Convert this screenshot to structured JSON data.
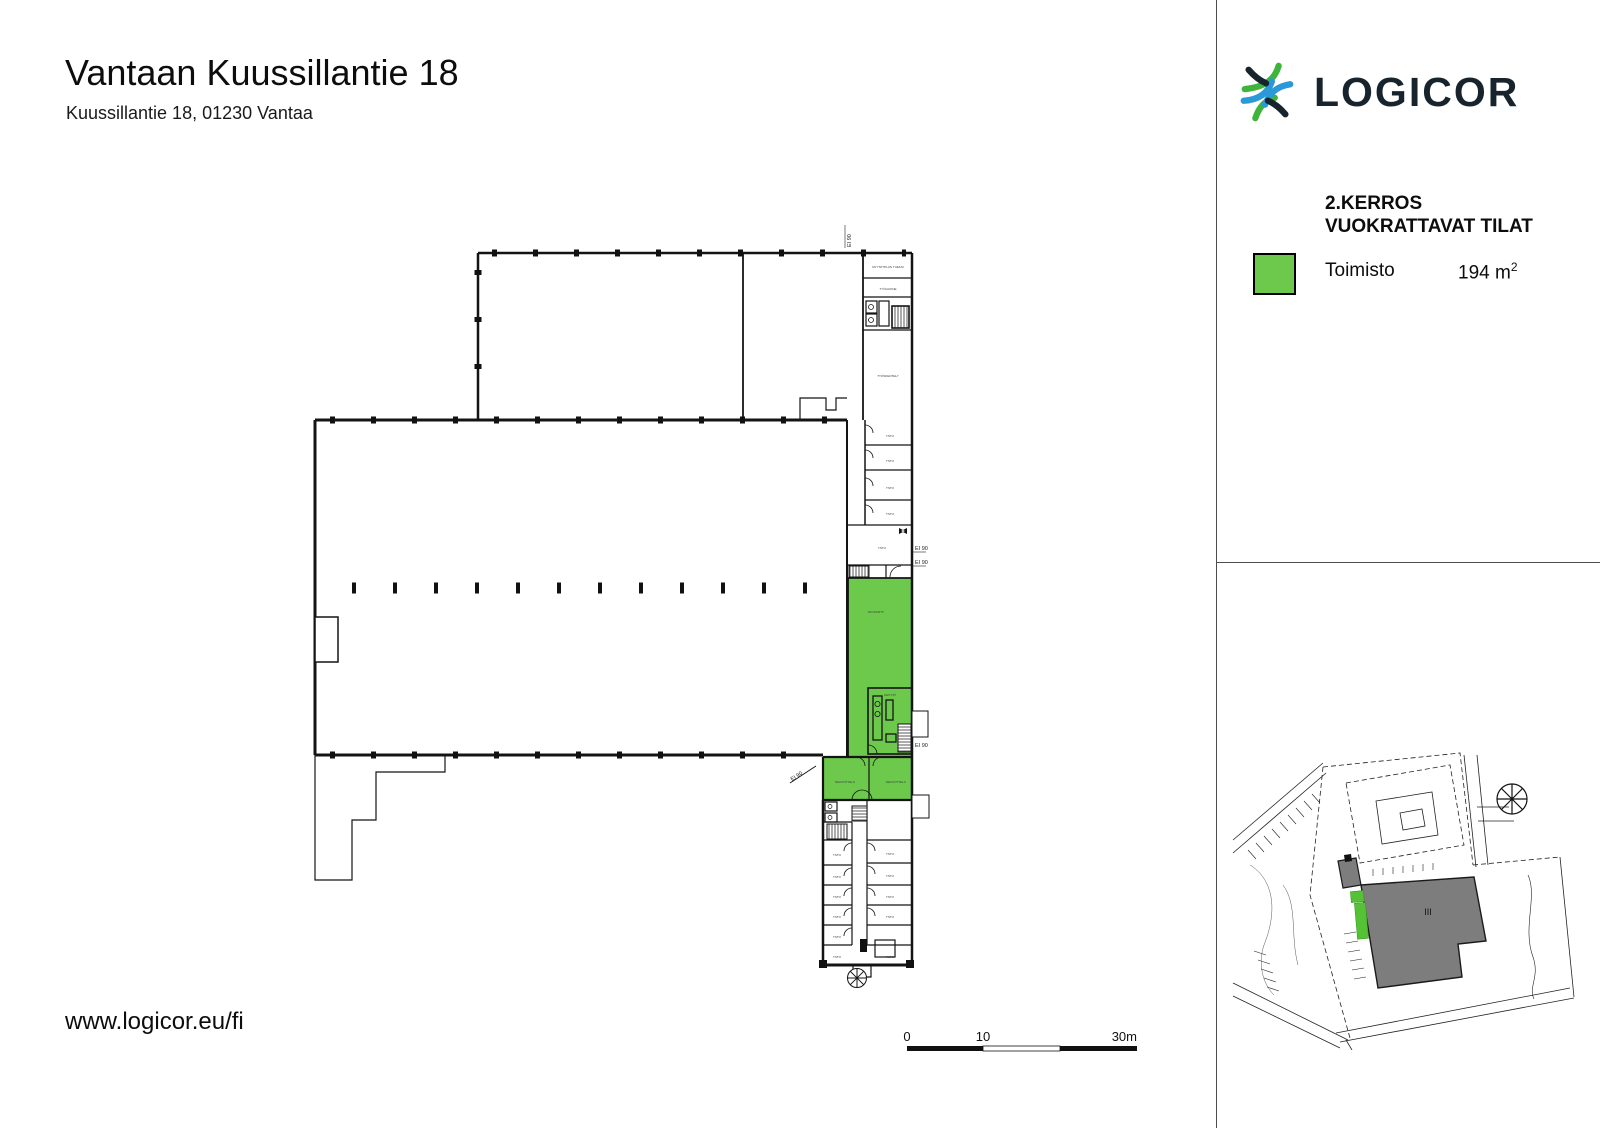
{
  "header": {
    "title": "Vantaan Kuussillantie 18",
    "subtitle": "Kuussillantie 18, 01230 Vantaa"
  },
  "branding": {
    "logo_text": "LOGICOR",
    "colors": {
      "navy": "#17242e",
      "green": "#3eb53a",
      "blue": "#2b98d8"
    }
  },
  "legend": {
    "floor_heading": "2.KERROS\nVUOKRATTAVAT TILAT",
    "items": [
      {
        "label": "Toimisto",
        "area_value": "194 m",
        "area_sup": "2",
        "color": "#6cc94c"
      }
    ]
  },
  "plan": {
    "highlight_color": "#6cc94c",
    "labels": {
      "tsto": "TSTO",
      "neuvottelu": "NEUVOTTELU",
      "keittio": "KEITTIÖ",
      "avokonttori": "AVOKONTT.",
      "tyohuone": "TYÖHUONE",
      "tyoskentely": "TYÖSKENTELY",
      "myyntitila": "MYYNTITILAN TUEKSI",
      "ei90": "EI 90"
    }
  },
  "scale_bar": {
    "tick_0": "0",
    "tick_10": "10",
    "tick_30": "30m"
  },
  "site_map": {
    "building_label": "III",
    "building_color": "#7d7d7d",
    "highlight_color": "#55c235"
  },
  "footer": {
    "website": "www.logicor.eu/fi"
  }
}
